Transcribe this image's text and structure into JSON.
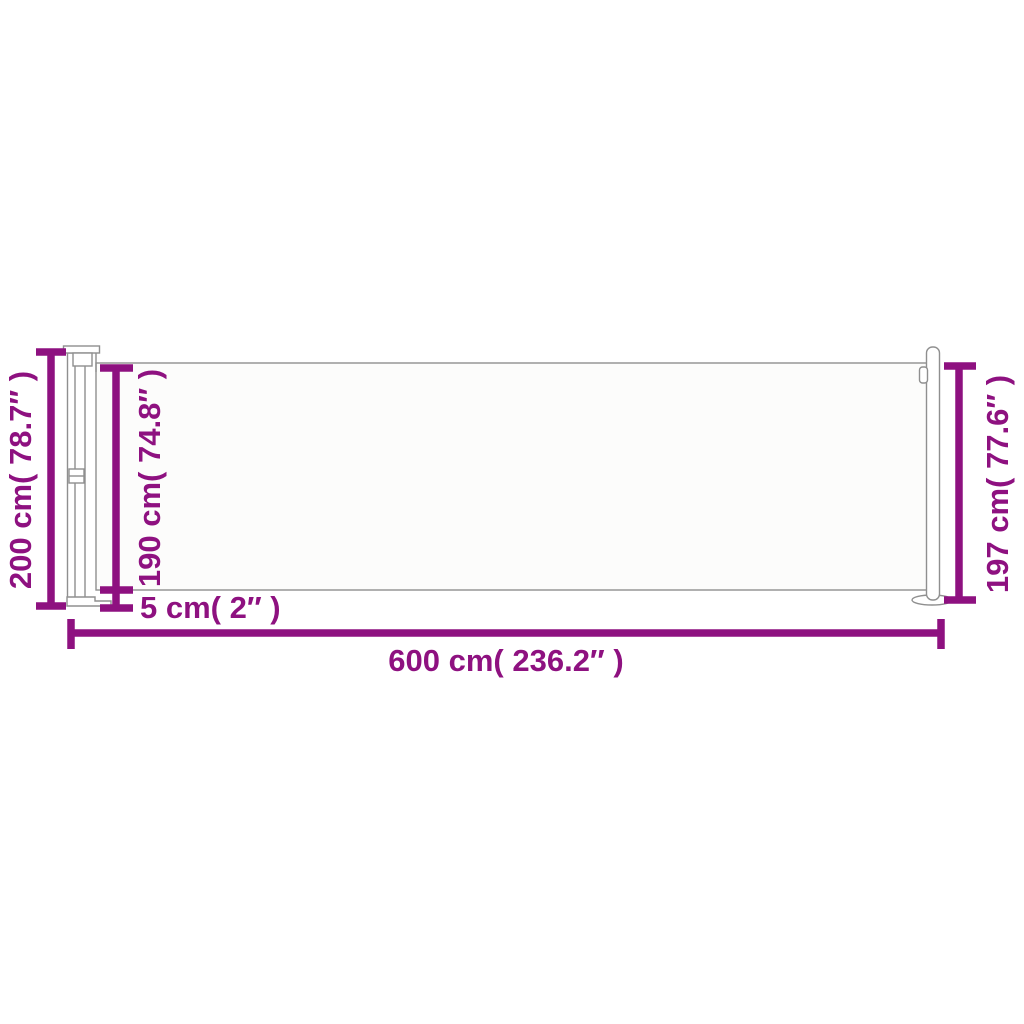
{
  "colors": {
    "dimension": "#8E1180",
    "outline": "#8F8F8F",
    "fabric": "#FCFCFB",
    "background": "#FFFFFF"
  },
  "dimensions": {
    "height_total": {
      "label": "200 cm( 78.7″ )",
      "value_cm": 200,
      "value_in": 78.7
    },
    "height_fabric": {
      "label": "190 cm( 74.8″ )",
      "value_cm": 190,
      "value_in": 74.8
    },
    "ground_gap": {
      "label": "5 cm( 2″ )",
      "value_cm": 5,
      "value_in": 2
    },
    "width_total": {
      "label": "600 cm( 236.2″ )",
      "value_cm": 600,
      "value_in": 236.2
    },
    "height_right": {
      "label": "197 cm( 77.6″ )",
      "value_cm": 197,
      "value_in": 77.6
    }
  }
}
